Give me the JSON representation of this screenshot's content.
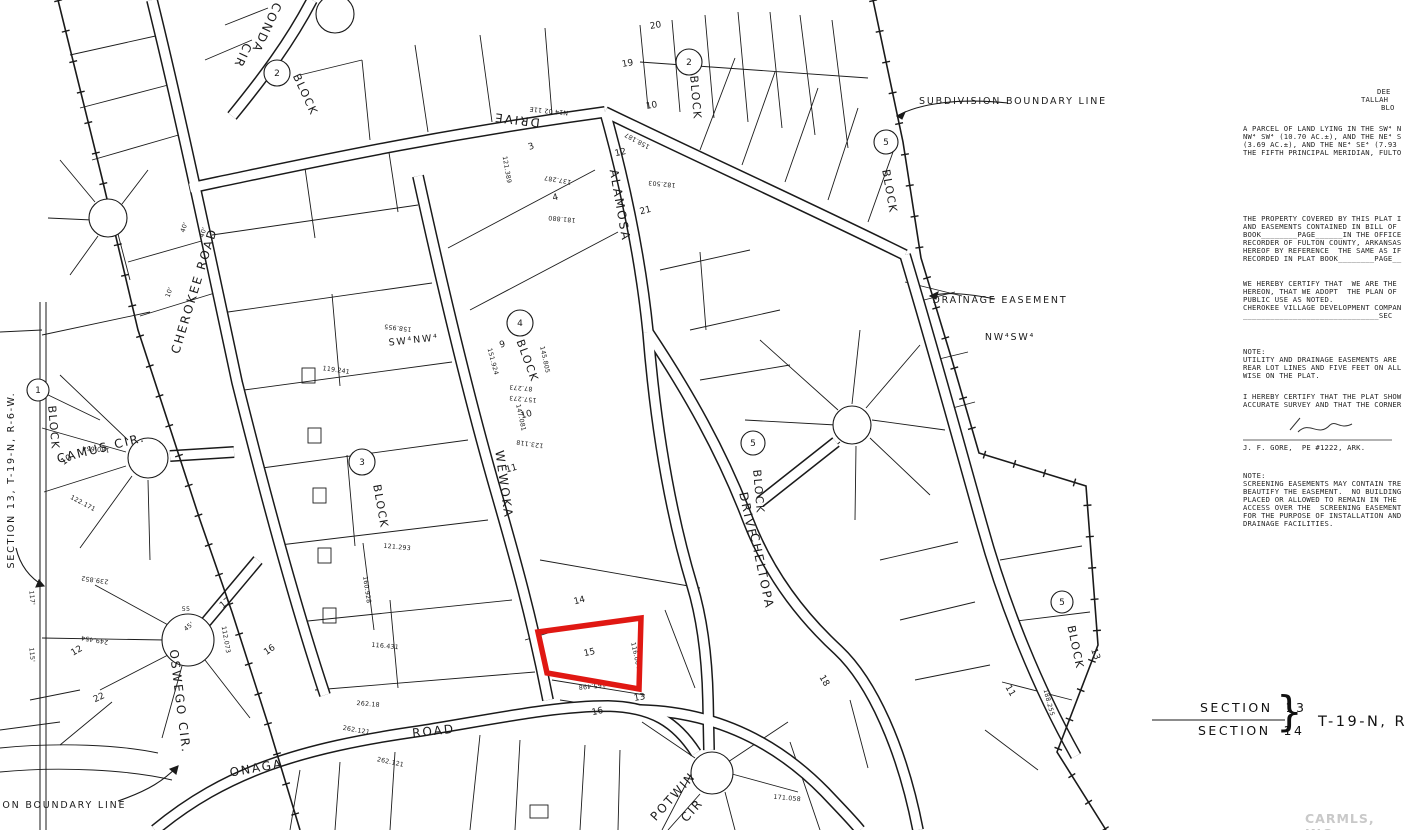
{
  "highlight": {
    "lot": "15",
    "color": "#e01813"
  },
  "map": {
    "labels": [
      {
        "t": "CHEROKEE ROAD",
        "x": 198,
        "y": 292,
        "r": -73,
        "cls": "road"
      },
      {
        "t": "CONDA",
        "x": 263,
        "y": 26,
        "r": 115,
        "cls": "road"
      },
      {
        "t": "CIR",
        "x": 239,
        "y": 54,
        "r": 115,
        "cls": "road"
      },
      {
        "t": "CAMUS CIR.",
        "x": 102,
        "y": 452,
        "r": -14,
        "cls": "road",
        "fs": 10
      },
      {
        "t": "OSWEGO CIR.",
        "x": 176,
        "y": 702,
        "r": 83,
        "cls": "road",
        "fs": 10
      },
      {
        "t": "WEWOKA",
        "x": 500,
        "y": 485,
        "r": 82,
        "cls": "road"
      },
      {
        "t": "DRIVE",
        "x": 517,
        "y": 116,
        "r": 187,
        "cls": "road"
      },
      {
        "t": "ALAMOSA",
        "x": 616,
        "y": 206,
        "r": 80,
        "cls": "road"
      },
      {
        "t": "ONAGA",
        "x": 257,
        "y": 772,
        "r": -10,
        "cls": "road",
        "fs": 14
      },
      {
        "t": "ROAD",
        "x": 434,
        "y": 735,
        "r": -6,
        "cls": "road",
        "fs": 14
      },
      {
        "t": "POTWIN",
        "x": 676,
        "y": 799,
        "r": -48,
        "cls": "road",
        "fs": 9
      },
      {
        "t": "CIR",
        "x": 695,
        "y": 813,
        "r": -48,
        "cls": "road",
        "fs": 9
      },
      {
        "t": "DRIVE",
        "x": 744,
        "y": 516,
        "r": 78,
        "cls": "road",
        "fs": 11
      },
      {
        "t": "CHELTOPA",
        "x": 758,
        "y": 572,
        "r": 78,
        "cls": "road",
        "fs": 10
      },
      {
        "t": "BLOCK",
        "x": 302,
        "y": 96,
        "r": 65,
        "cls": "block"
      },
      {
        "t": "BLOCK",
        "x": 692,
        "y": 98,
        "r": 85,
        "cls": "block"
      },
      {
        "t": "BLOCK",
        "x": 50,
        "y": 428,
        "r": 85,
        "cls": "block"
      },
      {
        "t": "BLOCK",
        "x": 377,
        "y": 507,
        "r": 80,
        "cls": "block"
      },
      {
        "t": "BLOCK",
        "x": 524,
        "y": 362,
        "r": 70,
        "cls": "block"
      },
      {
        "t": "BLOCK",
        "x": 755,
        "y": 492,
        "r": 85,
        "cls": "block"
      },
      {
        "t": "BLOCK",
        "x": 886,
        "y": 192,
        "r": 80,
        "cls": "block"
      },
      {
        "t": "BLOCK",
        "x": 1072,
        "y": 648,
        "r": 78,
        "cls": "block"
      },
      {
        "t": "SUBDIVISION  BOUNDARY  LINE",
        "x": 1013,
        "y": 104,
        "r": 0,
        "cls": "anno"
      },
      {
        "t": "DRAINAGE  EASEMENT",
        "x": 1000,
        "y": 303,
        "r": 0,
        "cls": "anno"
      },
      {
        "t": "NW⁴SW⁴",
        "x": 1010,
        "y": 340,
        "r": 0,
        "cls": "anno",
        "fs": 15
      },
      {
        "t": "SW⁴NW⁴",
        "x": 414,
        "y": 343,
        "r": -6,
        "cls": "anno",
        "fs": 12
      },
      {
        "t": "ION  BOUNDARY  LINE",
        "x": 62,
        "y": 808,
        "r": 0,
        "cls": "anno"
      },
      {
        "t": "SECTION 13, T-19-N, R-6-W.",
        "x": 14,
        "y": 480,
        "r": -90,
        "cls": "anno",
        "fs": 9
      },
      {
        "t": "15",
        "x": 590,
        "y": 655,
        "r": -12,
        "cls": "lot",
        "fs": 10
      },
      {
        "t": "14",
        "x": 580,
        "y": 603,
        "r": -14,
        "cls": "lot"
      },
      {
        "t": "13",
        "x": 640,
        "y": 700,
        "r": -10,
        "cls": "lot"
      },
      {
        "t": "16",
        "x": 598,
        "y": 714,
        "r": -12,
        "cls": "lot"
      },
      {
        "t": "9",
        "x": 503,
        "y": 347,
        "r": -15,
        "cls": "lot"
      },
      {
        "t": "10",
        "x": 527,
        "y": 417,
        "r": -15,
        "cls": "lot"
      },
      {
        "t": "11",
        "x": 512,
        "y": 471,
        "r": -15,
        "cls": "lot"
      },
      {
        "t": "3",
        "x": 532,
        "y": 149,
        "r": -20,
        "cls": "lot"
      },
      {
        "t": "4",
        "x": 556,
        "y": 200,
        "r": -15,
        "cls": "lot"
      },
      {
        "t": "10",
        "x": 652,
        "y": 108,
        "r": -10,
        "cls": "lot"
      },
      {
        "t": "12",
        "x": 621,
        "y": 155,
        "r": -12,
        "cls": "lot"
      },
      {
        "t": "21",
        "x": 646,
        "y": 213,
        "r": -14,
        "cls": "lot"
      },
      {
        "t": "19",
        "x": 628,
        "y": 66,
        "r": -10,
        "cls": "lot"
      },
      {
        "t": "20",
        "x": 656,
        "y": 28,
        "r": -10,
        "cls": "lot"
      },
      {
        "t": "18",
        "x": 822,
        "y": 682,
        "r": 60,
        "cls": "lot"
      },
      {
        "t": "17",
        "x": 227,
        "y": 605,
        "r": -40,
        "cls": "lot"
      },
      {
        "t": "16",
        "x": 271,
        "y": 652,
        "r": -35,
        "cls": "lot"
      },
      {
        "t": "12",
        "x": 78,
        "y": 653,
        "r": -30,
        "cls": "lot"
      },
      {
        "t": "22",
        "x": 100,
        "y": 700,
        "r": -25,
        "cls": "lot"
      },
      {
        "t": "10",
        "x": 68,
        "y": 462,
        "r": -35,
        "cls": "lot"
      },
      {
        "t": "55",
        "x": 186,
        "y": 611,
        "r": 0,
        "cls": "dim"
      },
      {
        "t": "13",
        "x": 1093,
        "y": 655,
        "r": 70,
        "cls": "lot"
      },
      {
        "t": "11",
        "x": 1008,
        "y": 692,
        "r": 60,
        "cls": "lot"
      },
      {
        "t": "165.498",
        "x": 592,
        "y": 684,
        "r": 174,
        "cls": "dim"
      },
      {
        "t": "116.004",
        "x": 634,
        "y": 656,
        "r": 78,
        "cls": "dim"
      },
      {
        "t": "180.654",
        "x": 96,
        "y": 447,
        "r": 184,
        "cls": "dim"
      },
      {
        "t": "122.171",
        "x": 82,
        "y": 505,
        "r": 28,
        "cls": "dim"
      },
      {
        "t": "239.852",
        "x": 95,
        "y": 578,
        "r": 188,
        "cls": "dim"
      },
      {
        "t": "249.454",
        "x": 95,
        "y": 638,
        "r": 190,
        "cls": "dim"
      },
      {
        "t": "262.121",
        "x": 356,
        "y": 732,
        "r": 10,
        "cls": "dim"
      },
      {
        "t": "262.121",
        "x": 390,
        "y": 764,
        "r": 12,
        "cls": "dim"
      },
      {
        "t": "262.18",
        "x": 368,
        "y": 706,
        "r": 5,
        "cls": "dim"
      },
      {
        "t": "158.955",
        "x": 398,
        "y": 326,
        "r": 187,
        "cls": "dim"
      },
      {
        "t": "121.389",
        "x": 505,
        "y": 170,
        "r": 80,
        "cls": "dim"
      },
      {
        "t": "137.287",
        "x": 558,
        "y": 178,
        "r": 190,
        "cls": "dim"
      },
      {
        "t": "181.880",
        "x": 562,
        "y": 217,
        "r": 185,
        "cls": "dim"
      },
      {
        "t": "158.187",
        "x": 638,
        "y": 139,
        "r": 208,
        "cls": "dim"
      },
      {
        "t": "182.503",
        "x": 662,
        "y": 182,
        "r": 185,
        "cls": "dim"
      },
      {
        "t": "112.073",
        "x": 224,
        "y": 640,
        "r": 80,
        "cls": "dim"
      },
      {
        "t": "171.058",
        "x": 787,
        "y": 800,
        "r": 5,
        "cls": "dim"
      },
      {
        "t": "123.118",
        "x": 530,
        "y": 442,
        "r": 188,
        "cls": "dim"
      },
      {
        "t": "151.924",
        "x": 491,
        "y": 362,
        "r": 75,
        "cls": "dim"
      },
      {
        "t": "145.805",
        "x": 543,
        "y": 360,
        "r": 78,
        "cls": "dim"
      },
      {
        "t": "87.273",
        "x": 521,
        "y": 386,
        "r": 185,
        "cls": "dim"
      },
      {
        "t": "157.273",
        "x": 523,
        "y": 397,
        "r": 185,
        "cls": "dim"
      },
      {
        "t": "147.081",
        "x": 519,
        "y": 418,
        "r": 78,
        "cls": "dim"
      },
      {
        "t": "119.241",
        "x": 336,
        "y": 372,
        "r": 8,
        "cls": "dim"
      },
      {
        "t": "116.431",
        "x": 385,
        "y": 648,
        "r": 5,
        "cls": "dim"
      },
      {
        "t": "121.293",
        "x": 397,
        "y": 549,
        "r": 5,
        "cls": "dim"
      },
      {
        "t": "160.928",
        "x": 365,
        "y": 590,
        "r": 82,
        "cls": "dim"
      },
      {
        "t": "188.255",
        "x": 1047,
        "y": 703,
        "r": 75,
        "cls": "dim"
      },
      {
        "t": "N14 02 11E",
        "x": 549,
        "y": 109,
        "r": 186,
        "cls": "dim"
      },
      {
        "t": "40'",
        "x": 186,
        "y": 228,
        "r": -70,
        "cls": "dim"
      },
      {
        "t": "40'",
        "x": 205,
        "y": 233,
        "r": -70,
        "cls": "dim"
      },
      {
        "t": "10'",
        "x": 171,
        "y": 293,
        "r": -70,
        "cls": "dim"
      },
      {
        "t": "115'",
        "x": 30,
        "y": 655,
        "r": 85,
        "cls": "dim"
      },
      {
        "t": "117'",
        "x": 30,
        "y": 598,
        "r": 85,
        "cls": "dim"
      },
      {
        "t": "45'",
        "x": 190,
        "y": 628,
        "r": -40,
        "cls": "dim"
      }
    ],
    "circled_numbers": [
      {
        "t": "1",
        "x": 38,
        "y": 390,
        "rad": 11
      },
      {
        "t": "2",
        "x": 277,
        "y": 73,
        "rad": 13
      },
      {
        "t": "2",
        "x": 689,
        "y": 62,
        "rad": 13
      },
      {
        "t": "3",
        "x": 362,
        "y": 462,
        "rad": 13
      },
      {
        "t": "4",
        "x": 520,
        "y": 323,
        "rad": 13
      },
      {
        "t": "5",
        "x": 753,
        "y": 443,
        "rad": 12
      },
      {
        "t": "5",
        "x": 886,
        "y": 142,
        "rad": 12
      },
      {
        "t": "5",
        "x": 1062,
        "y": 602,
        "rad": 11
      }
    ]
  },
  "margin": {
    "lines": [
      {
        "t": "DEE",
        "x": 1377,
        "y": 88
      },
      {
        "t": "TALLAH",
        "x": 1361,
        "y": 96
      },
      {
        "t": "BLO",
        "x": 1381,
        "y": 104
      },
      {
        "t": "A PARCEL OF LAND LYING IN THE SW⁴ N",
        "x": 1243,
        "y": 125
      },
      {
        "t": "NW⁴ SW⁴ (10.70 AC.±), AND THE NE⁴ S",
        "x": 1243,
        "y": 133
      },
      {
        "t": "(3.69 AC.±), AND THE NE⁴ SE⁴ (7.93",
        "x": 1243,
        "y": 141
      },
      {
        "t": "THE FIFTH PRINCIPAL MERIDIAN, FULTO",
        "x": 1243,
        "y": 149
      },
      {
        "t": "THE PROPERTY COVERED BY THIS PLAT I",
        "x": 1243,
        "y": 215
      },
      {
        "t": "AND EASEMENTS CONTAINED IN BILL OF",
        "x": 1243,
        "y": 223
      },
      {
        "t": "BOOK________PAGE______IN THE OFFICE",
        "x": 1243,
        "y": 231
      },
      {
        "t": "RECORDER OF FULTON COUNTY, ARKANSAS",
        "x": 1243,
        "y": 239
      },
      {
        "t": "HEREOF BY REFERENCE  THE SAME AS IF",
        "x": 1243,
        "y": 247
      },
      {
        "t": "RECORDED IN PLAT BOOK________PAGE__",
        "x": 1243,
        "y": 255
      },
      {
        "t": "WE HEREBY CERTIFY THAT  WE ARE THE",
        "x": 1243,
        "y": 280
      },
      {
        "t": "HEREON, THAT WE ADOPT  THE PLAN OF",
        "x": 1243,
        "y": 288
      },
      {
        "t": "PUBLIC USE AS NOTED.",
        "x": 1243,
        "y": 296
      },
      {
        "t": "CHEROKEE VILLAGE DEVELOPMENT COMPAN",
        "x": 1243,
        "y": 304
      },
      {
        "t": "______________________________SEC",
        "x": 1243,
        "y": 312
      },
      {
        "t": "NOTE:",
        "x": 1243,
        "y": 348
      },
      {
        "t": "UTILITY AND DRAINAGE EASEMENTS ARE",
        "x": 1243,
        "y": 356
      },
      {
        "t": "REAR LOT LINES AND FIVE FEET ON ALL",
        "x": 1243,
        "y": 364
      },
      {
        "t": "WISE ON THE PLAT.",
        "x": 1243,
        "y": 372
      },
      {
        "t": "I HEREBY CERTIFY THAT THE PLAT SHOW",
        "x": 1243,
        "y": 393
      },
      {
        "t": "ACCURATE SURVEY AND THAT THE CORNER",
        "x": 1243,
        "y": 401
      },
      {
        "t": "J. F. GORE,  PE #1222, ARK.",
        "x": 1243,
        "y": 444
      },
      {
        "t": "NOTE:",
        "x": 1243,
        "y": 472
      },
      {
        "t": "SCREENING EASEMENTS MAY CONTAIN TRE",
        "x": 1243,
        "y": 480
      },
      {
        "t": "BEAUTIFY THE EASEMENT.  NO BUILDING",
        "x": 1243,
        "y": 488
      },
      {
        "t": "PLACED OR ALLOWED TO REMAIN IN THE",
        "x": 1243,
        "y": 496
      },
      {
        "t": "ACCESS OVER THE  SCREENING EASEMENT",
        "x": 1243,
        "y": 504
      },
      {
        "t": "FOR THE PURPOSE OF INSTALLATION AND",
        "x": 1243,
        "y": 512
      },
      {
        "t": "DRAINAGE FACILITIES.",
        "x": 1243,
        "y": 520
      },
      {
        "t": "SECTION  13",
        "x": 1200,
        "y": 701,
        "cls": "hand",
        "fs": 12.5
      },
      {
        "t": "SECTION  14",
        "x": 1198,
        "y": 724,
        "cls": "hand",
        "fs": 12.5
      },
      {
        "t": "}",
        "x": 1276,
        "y": 690,
        "cls": "hand",
        "fs": 42
      },
      {
        "t": "T-19-N, R-",
        "x": 1318,
        "y": 715,
        "cls": "hand",
        "fs": 14.5
      }
    ]
  },
  "watermark": "CARMLS, INC"
}
